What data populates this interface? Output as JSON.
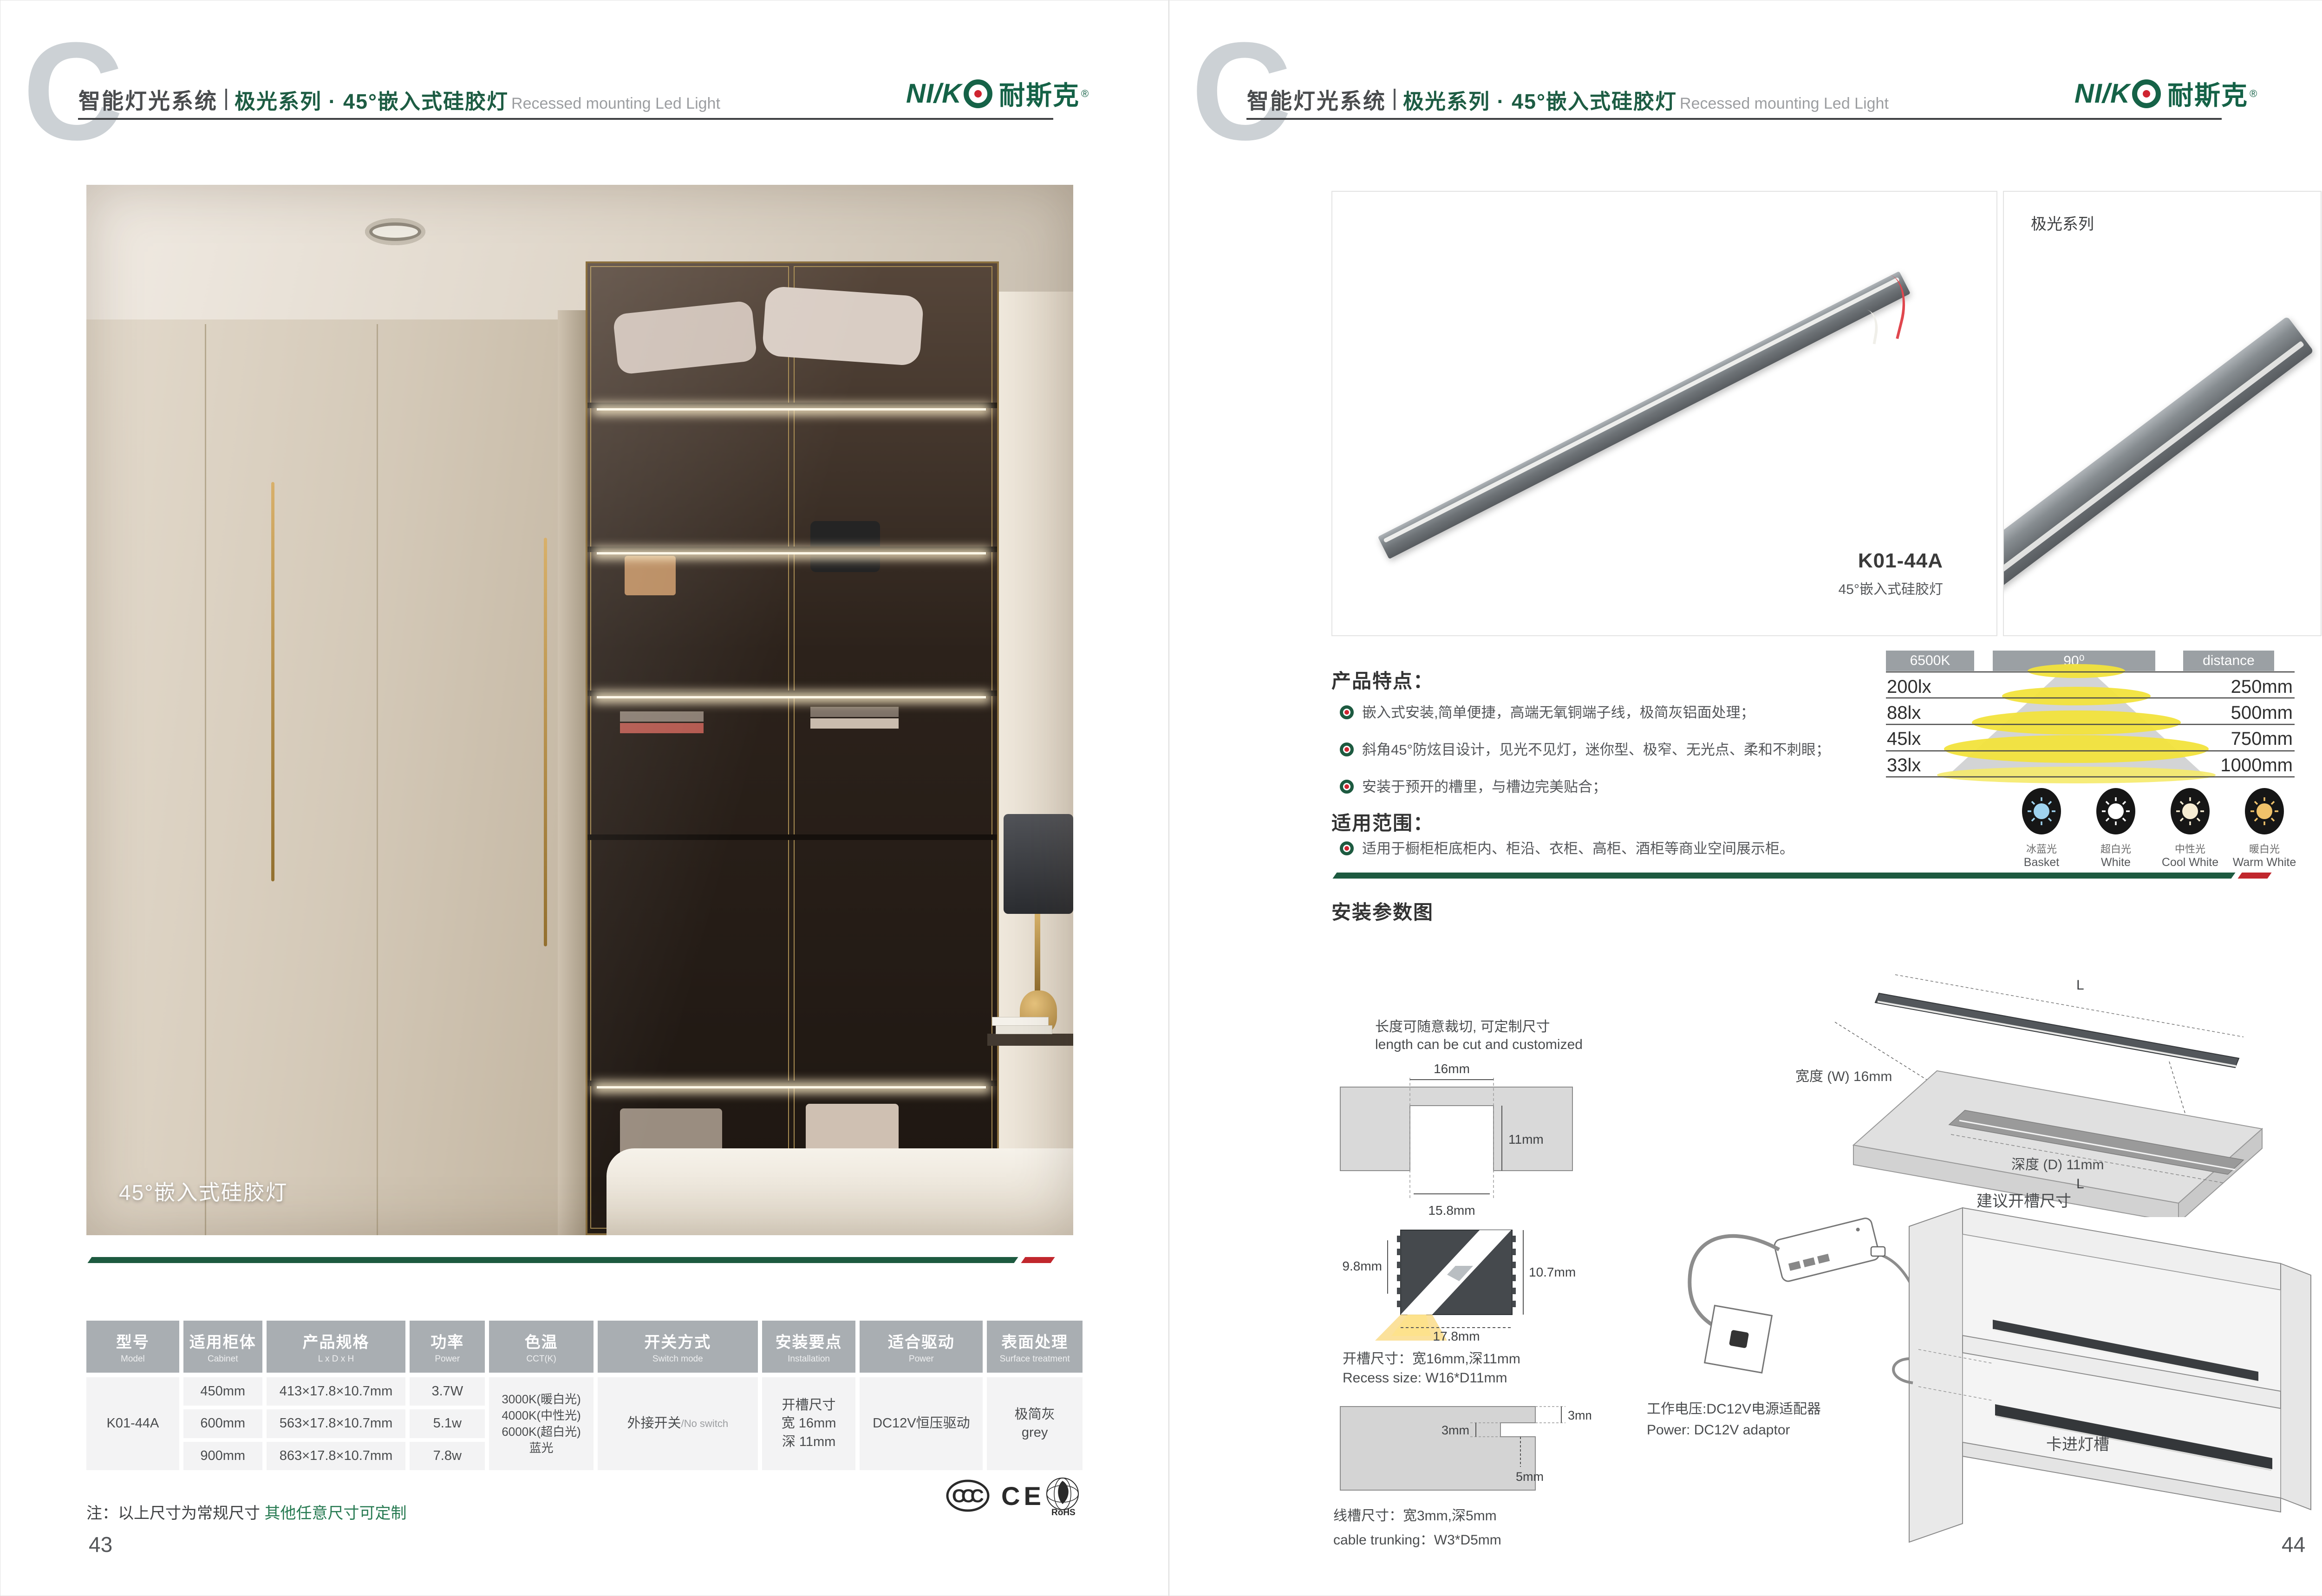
{
  "header": {
    "letter": "C",
    "system": "智能灯光系统",
    "series": "极光系列 · 45°嵌入式硅胶灯",
    "subtitle": "Recessed mounting Led Light"
  },
  "logo": {
    "latin": "NI/K",
    "cn": "耐斯克",
    "reg": "®"
  },
  "colors": {
    "brand_green": "#156247",
    "accent_green": "#1d5a40",
    "accent_red": "#c1272d",
    "table_header_gray": "#a9aeb2"
  },
  "page_left": {
    "photo_caption": "45°嵌入式硅胶灯",
    "table": {
      "headers": [
        {
          "cn": "型号",
          "en": "Model"
        },
        {
          "cn": "适用柜体",
          "en": "Cabinet"
        },
        {
          "cn": "产品规格",
          "en": "L x D x H"
        },
        {
          "cn": "功率",
          "en": "Power"
        },
        {
          "cn": "色温",
          "en": "CCT(K)"
        },
        {
          "cn": "开关方式",
          "en": "Switch mode"
        },
        {
          "cn": "安装要点",
          "en": "Installation"
        },
        {
          "cn": "适合驱动",
          "en": "Power"
        },
        {
          "cn": "表面处理",
          "en": "Surface treatment"
        }
      ],
      "model": "K01-44A",
      "rows": [
        {
          "cabinet": "450mm",
          "spec": "413×17.8×10.7mm",
          "power": "3.7W"
        },
        {
          "cabinet": "600mm",
          "spec": "563×17.8×10.7mm",
          "power": "5.1w"
        },
        {
          "cabinet": "900mm",
          "spec": "863×17.8×10.7mm",
          "power": "7.8w"
        }
      ],
      "cct_lines": [
        "3000K(暖白光)",
        "4000K(中性光)",
        "6000K(超白光)",
        "蓝光"
      ],
      "switch_cn": "外接开关",
      "switch_en": "/No switch",
      "installation_lines": [
        "开槽尺寸",
        "宽 16mm",
        "深 11mm"
      ],
      "driver": "DC12V恒压驱动",
      "surface_cn": "极简灰",
      "surface_en": "grey"
    },
    "note_prefix": "注：以上尺寸为常规尺寸 ",
    "note_highlight": "其他任意尺寸可定制",
    "cert_ccc": "CCC",
    "cert_ce": "CE",
    "cert_rohs": "RoHS",
    "page_number": "43"
  },
  "page_right": {
    "series_label": "极光系列",
    "product_model": "K01-44A",
    "product_name": "45°嵌入式硅胶灯",
    "features_title": "产品特点：",
    "features": [
      "嵌入式安装,简单便捷，高端无氧铜端子线，极简灰铝面处理；",
      "斜角45°防炫目设计，见光不见灯，迷你型、极窄、无光点、柔和不刺眼；",
      "安装于预开的槽里，与槽边完美贴合；"
    ],
    "scope_title": "适用范围：",
    "scope_items": [
      "适用于橱柜柜底柜内、柜沿、衣柜、高柜、酒柜等商业空间展示柜。"
    ],
    "install_title": "安装参数图",
    "cut_note_cn": "长度可随意裁切, 可定制尺寸",
    "cut_note_en": "length can be cut and customized",
    "groove": {
      "w_top": "16mm",
      "depth": "11mm",
      "w_bottom": "15.8mm"
    },
    "profile": {
      "h_left": "9.8mm",
      "h_right": "10.7mm",
      "w_bottom": "17.8mm"
    },
    "recess_cn": "开槽尺寸：宽16mm,深11mm",
    "recess_en": "Recess size: W16*D11mm",
    "trunk": {
      "top": "3mm",
      "side": "3mm",
      "bottom": "5mm"
    },
    "trunk_cn": "线槽尺寸：宽3mm,深5mm",
    "trunk_en": "cable trunking：W3*D5mm",
    "board": {
      "len_top": "L",
      "len_groove": "L",
      "width_label": "宽度 (W) 16mm",
      "depth_label": "深度 (D) 11mm",
      "suggest": "建议开槽尺寸"
    },
    "power_cn": "工作电压:DC12V电源适配器",
    "power_en": "Power: DC12V adaptor",
    "clip_label": "卡进灯槽",
    "page_number": "44"
  },
  "chart_data": {
    "type": "table",
    "title": "Illuminance vs distance (6500K, 90° beam)",
    "cct_label": "6500K",
    "beam_angle": "90⁰",
    "distance_label": "distance",
    "rows": [
      {
        "lux": "200lx",
        "distance": "250mm"
      },
      {
        "lux": "88lx",
        "distance": "500mm"
      },
      {
        "lux": "45lx",
        "distance": "750mm"
      },
      {
        "lux": "33lx",
        "distance": "1000mm"
      }
    ],
    "swatches": [
      {
        "cn": "冰蓝光",
        "en": "Basket",
        "color": "#9fd3ef"
      },
      {
        "cn": "超白光",
        "en": "White",
        "color": "#ffffff"
      },
      {
        "cn": "中性光",
        "en": "Cool White",
        "color": "#f6ecd2"
      },
      {
        "cn": "暖白光",
        "en": "Warm White",
        "color": "#f0c26a"
      }
    ]
  }
}
